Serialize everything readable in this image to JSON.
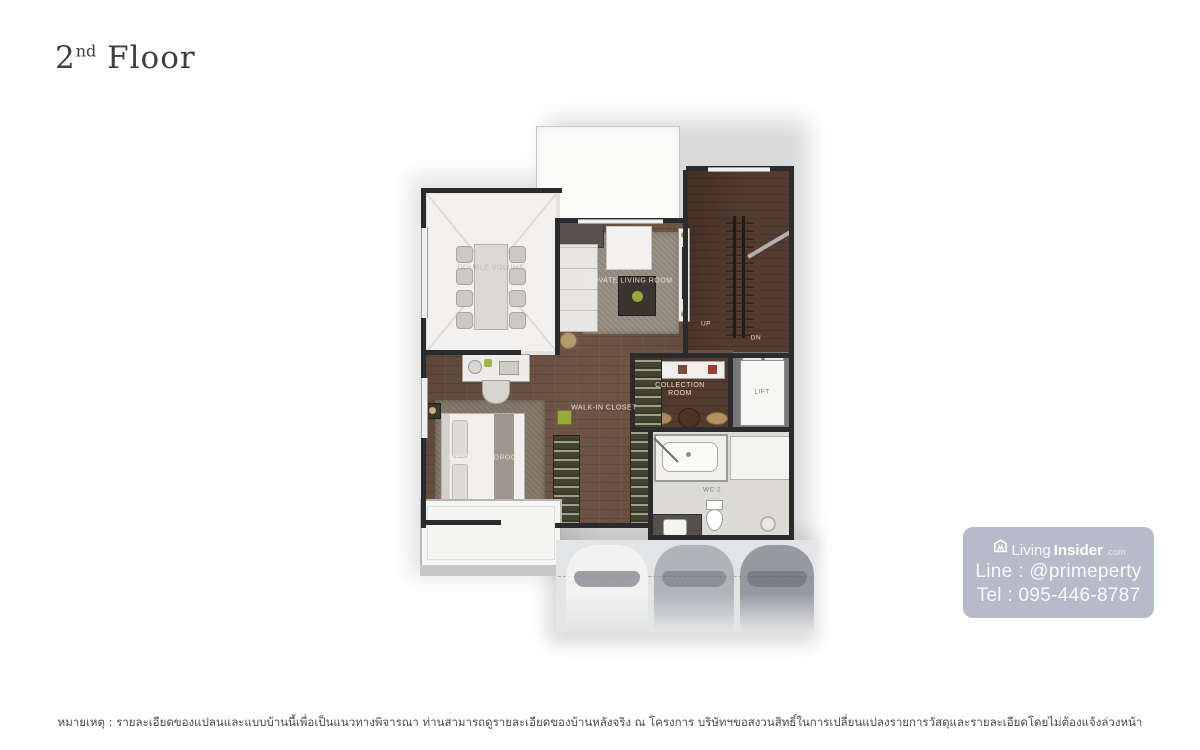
{
  "title": {
    "number": "2",
    "ordinal": "nd",
    "word": " Floor"
  },
  "floorplan": {
    "labels": {
      "double_volume": "DOUBLE VOLUME",
      "private_living_room": "PRIVATE LIVING ROOM",
      "master_bedroom": "MASTER BEDROOM",
      "walk_in_closet": "WALK-IN CLOSET",
      "collection_room_line1": "COLLECTION",
      "collection_room_line2": "ROOM",
      "lift": "LIFT",
      "up": "UP",
      "dn": "DN",
      "wc": "WC 2"
    },
    "colors": {
      "wall": "#2b2b2d",
      "wood_floor": "#6f5546",
      "stair_wood": "#543b2f",
      "white_room": "#f2f1ef",
      "tile": "#dcdad6",
      "accent_green": "#97a83e"
    }
  },
  "watermark": {
    "brand_prefix": "Living",
    "brand_suffix": "Insider",
    "brand_tld": ".com",
    "line_label": "Line : @primeperty",
    "tel_label": "Tel : 095-446-8787"
  },
  "footer": {
    "note": "หมายเหตุ : รายละเอียดของแปลนและแบบบ้านนี้เพื่อเป็นแนวทางพิจารณา ท่านสามารถดูรายละเอียดของบ้านหลังจริง ณ โครงการ บริษัทฯขอสงวนสิทธิ์ในการเปลี่ยนแปลงรายการวัสดุและรายละเอียดโดยไม่ต้องแจ้งล่วงหน้า"
  }
}
